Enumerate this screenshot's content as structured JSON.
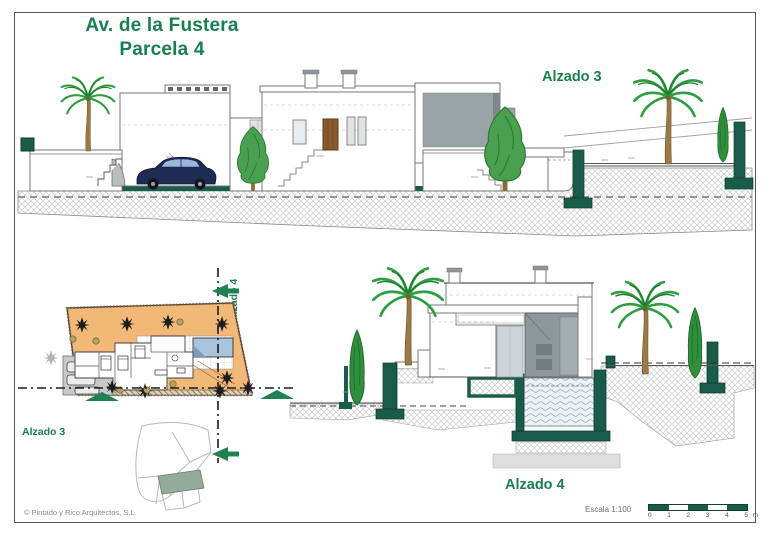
{
  "sheet": {
    "title_line1": "Av. de la Fustera",
    "title_line2": "Parcela 4",
    "copyright": "© Pintado y Rico Arquitectos, S.L."
  },
  "labels": {
    "top_elevation": "Alzado 3",
    "bottom_elevation": "Alzado 4",
    "plan_section_h": "Alzado 3",
    "plan_section_v": "Alzado 4"
  },
  "scale": {
    "label": "Escala 1:100",
    "ticks": [
      "0",
      "1",
      "2",
      "3",
      "4",
      "5"
    ],
    "unit": "m"
  },
  "colors": {
    "accent_green": "#17804e",
    "structure_green": "#1a5c4a",
    "arrow_green": "#1f8050",
    "parcel_orange": "#f2b878",
    "pool_blue": "#aac4dc",
    "car_navy": "#1e2b52"
  }
}
